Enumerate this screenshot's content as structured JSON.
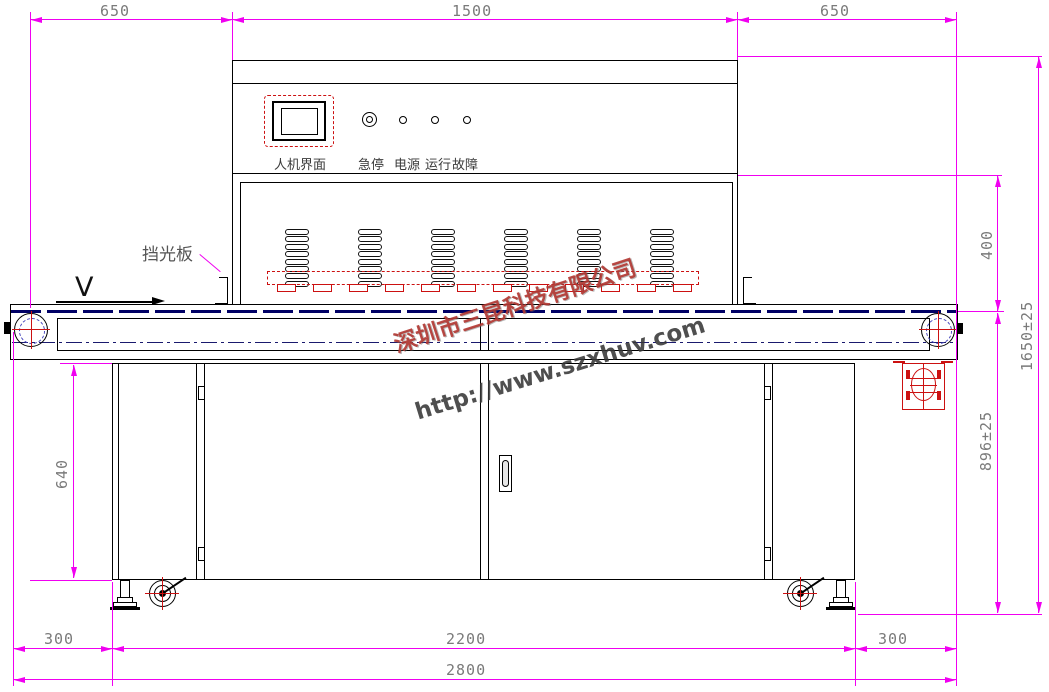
{
  "watermark": {
    "company": "深圳市三昆科技有限公司",
    "url": "http://www.szxhuv.com"
  },
  "panel": {
    "hmi_label": "人机界面",
    "indicators": [
      {
        "label": "急停"
      },
      {
        "label": "电源"
      },
      {
        "label": "运行"
      },
      {
        "label": "故障"
      }
    ]
  },
  "annotations": {
    "light_shield": "挡光板",
    "direction": "V"
  },
  "dimensions": {
    "top": [
      "650",
      "1500",
      "650"
    ],
    "right": {
      "lamp_to_belt": "400",
      "total_height": "1650±25",
      "belt_to_floor": "896±25"
    },
    "left": {
      "cabinet_height": "640"
    },
    "bottom": {
      "left_overhang": "300",
      "cabinet_width": "2200",
      "right_overhang": "300",
      "total_length": "2800"
    }
  },
  "machine": {
    "lamp_modules": 6,
    "slats_per_module": 8
  },
  "colors": {
    "dimension": "#f000f0",
    "dim_text": "#7a7a7a",
    "outline": "#000000",
    "belt": "#000066",
    "accent_red": "#cc1111"
  }
}
